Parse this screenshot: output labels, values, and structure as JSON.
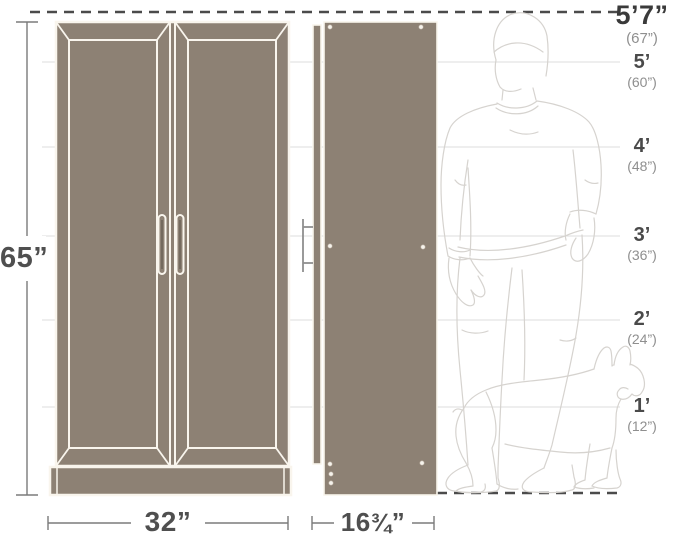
{
  "diagram": {
    "type": "furniture-dimension-diagram",
    "subject": "two-door storage cabinet shown in front view and side view next to adult-male and dog outlines for scale"
  },
  "dimensions": {
    "height": {
      "label": "65”"
    },
    "width": {
      "label": "32”"
    },
    "depth": {
      "whole": "16",
      "frac": "¾",
      "quote": "”"
    }
  },
  "height_markers": [
    {
      "feet": "5’7”",
      "inches": "(67”)"
    },
    {
      "feet": "5’",
      "inches": "(60”)"
    },
    {
      "feet": "4’",
      "inches": "(48”)"
    },
    {
      "feet": "3’",
      "inches": "(36”)"
    },
    {
      "feet": "2’",
      "inches": "(24”)"
    },
    {
      "feet": "1’",
      "inches": "(12”)"
    }
  ],
  "figures": {
    "person_icon": "adult-male-outline",
    "dog_icon": "french-bulldog-outline"
  },
  "colors": {
    "cabinet_fill": "#8d8174",
    "cabinet_line": "#f9f5ed",
    "text_dark": "#4a4a4a",
    "text_gray": "#8f8f8f",
    "dimension_line": "#7b7b7b",
    "dashed_line": "#4b4b4b",
    "gridline": "#dcdcdc",
    "figure_outline": "#d6d3cf"
  }
}
